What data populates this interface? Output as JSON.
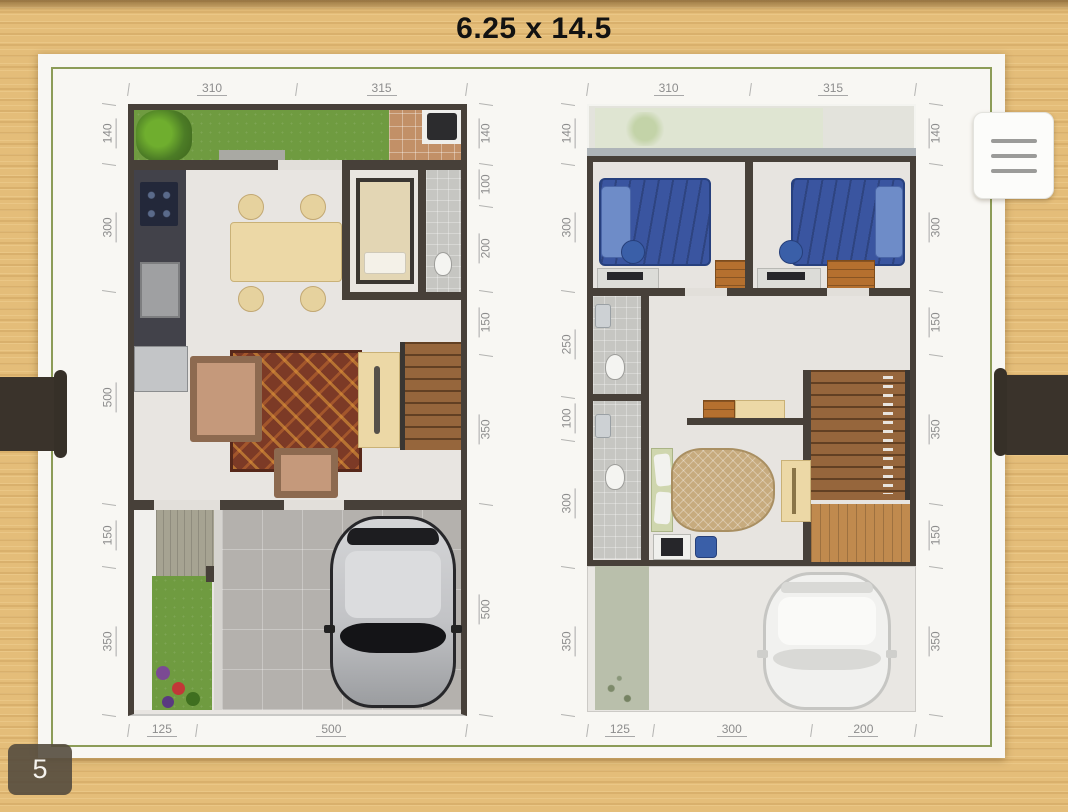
{
  "app": {
    "title": "6.25 x 14.5",
    "page_number": "5",
    "menu_icon": "hamburger-icon"
  },
  "colors": {
    "frame_accent": "#8c9c57",
    "wood_background": "#e4bd79",
    "wall": "#474039",
    "nav_tab": "#3a332b",
    "dimension_text": "#8c8c8c"
  },
  "plans": [
    {
      "id": "ground-floor",
      "dims_top": [
        "310",
        "315"
      ],
      "dims_bottom": [
        "125",
        "500"
      ],
      "dims_left": [
        "140",
        "300",
        "500",
        "150",
        "350"
      ],
      "dims_right": [
        "140",
        "100",
        "200",
        "150",
        "350",
        "500"
      ]
    },
    {
      "id": "upper-floor",
      "dims_top": [
        "310",
        "315"
      ],
      "dims_bottom": [
        "125",
        "300",
        "200"
      ],
      "dims_left": [
        "140",
        "300",
        "250",
        "100",
        "300",
        "350"
      ],
      "dims_right": [
        "140",
        "300",
        "150",
        "350",
        "150",
        "350"
      ]
    }
  ]
}
